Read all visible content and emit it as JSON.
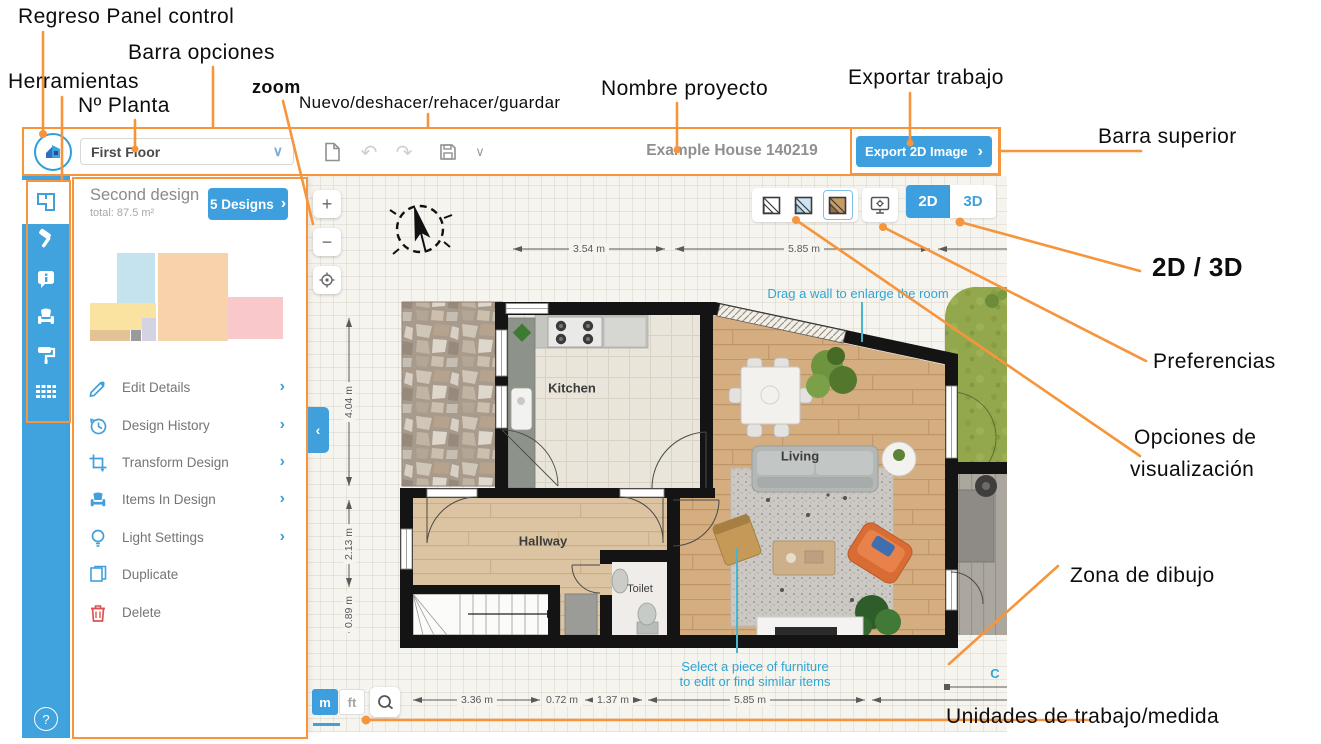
{
  "colors": {
    "annotation_orange": "#f6953c",
    "brand_blue": "#41a0dc",
    "hint_teal": "#2fa6d3",
    "delete_red": "#e05252",
    "wall_black": "#141414"
  },
  "annotations": {
    "regreso": "Regreso Panel control",
    "herramientas": "Herramientas",
    "n_planta": "Nº Planta",
    "barra_opciones": "Barra opciones",
    "zoom": "zoom",
    "nuevo": "Nuevo/deshacer/rehacer/guardar",
    "nombre": "Nombre proyecto",
    "exportar": "Exportar trabajo",
    "barra_superior": "Barra superior",
    "dos_tres_d": "2D / 3D",
    "preferencias": "Preferencias",
    "opciones_line1": "Opciones de",
    "opciones_line2": "visualización",
    "zona": "Zona de dibujo",
    "unidades": "Unidades de trabajo/medida"
  },
  "icons": {
    "chevron_right": "›",
    "chevron_down": "∨",
    "undo": "↶",
    "redo": "↷",
    "help": "?",
    "plus": "+",
    "minus": "−",
    "collapse": "‹"
  },
  "topbar": {
    "floor_selector": "First Floor",
    "project_name": "Example House 140219",
    "export_label": "Export 2D Image"
  },
  "panel": {
    "design_name": "Second design",
    "design_total": "total: 87.5 m²",
    "designs_button": "5 Designs",
    "menu": [
      {
        "label": "Edit Details"
      },
      {
        "label": "Design History"
      },
      {
        "label": "Transform Design"
      },
      {
        "label": "Items In Design"
      },
      {
        "label": "Light Settings"
      },
      {
        "label": "Duplicate"
      },
      {
        "label": "Delete"
      }
    ]
  },
  "canvas": {
    "compass": "N",
    "view_toggle": {
      "d2": "2D",
      "d3": "3D"
    },
    "units": {
      "metric": "m",
      "imperial": "ft"
    },
    "rooms": {
      "kitchen": "Kitchen",
      "living": "Living",
      "hallway": "Hallway",
      "toilet": "Toilet"
    },
    "hints": {
      "drag_wall": "Drag a wall to enlarge the room",
      "select_furniture_1": "Select a piece of furniture",
      "select_furniture_2": "to edit or find similar items",
      "clipped": "C"
    },
    "dims": {
      "top": [
        "3.54 m",
        "5.85 m"
      ],
      "left": [
        "4.04 m",
        "2.13 m",
        "0.89 m"
      ],
      "bottom": [
        "3.36 m",
        "0.72 m",
        "1.37 m",
        "5.85 m"
      ]
    }
  }
}
